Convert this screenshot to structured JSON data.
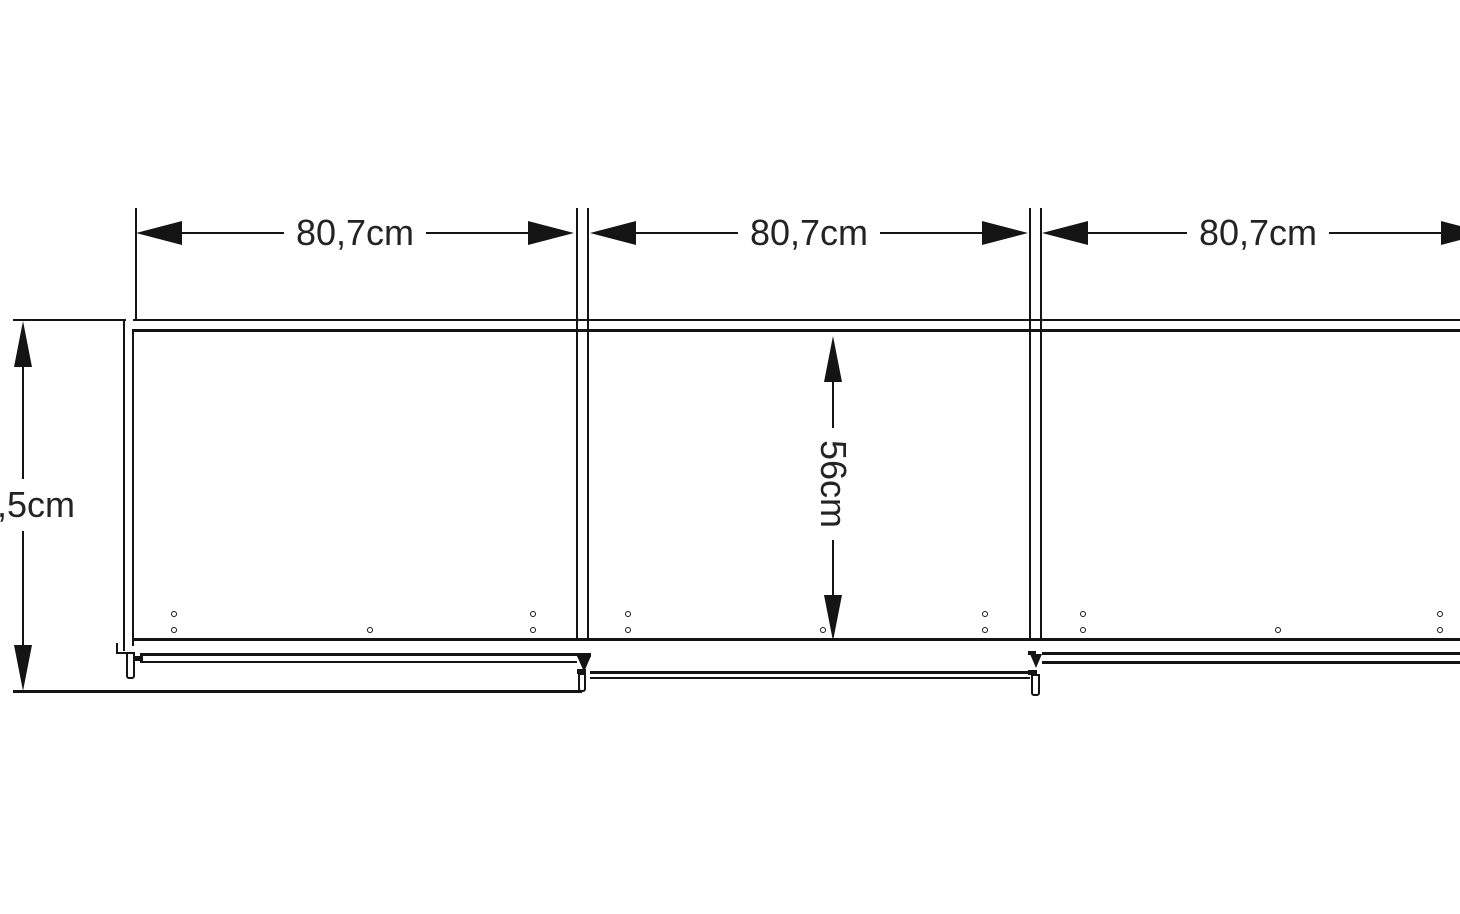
{
  "diagram": {
    "labels": {
      "section_width_1": "80,7cm",
      "section_width_2": "80,7cm",
      "section_width_3": "80,7cm",
      "overall_depth": ",5cm",
      "inner_depth": "56cm"
    },
    "colors": {
      "line": "#141414",
      "text": "#232323",
      "background": "#ffffff"
    },
    "holes": [
      [
        174,
        614
      ],
      [
        174,
        630
      ],
      [
        370,
        630
      ],
      [
        533,
        614
      ],
      [
        533,
        630
      ],
      [
        628,
        614
      ],
      [
        628,
        630
      ],
      [
        823,
        630
      ],
      [
        985,
        614
      ],
      [
        985,
        630
      ],
      [
        1083,
        614
      ],
      [
        1083,
        630
      ],
      [
        1278,
        630
      ],
      [
        1440,
        614
      ],
      [
        1440,
        630
      ]
    ]
  }
}
